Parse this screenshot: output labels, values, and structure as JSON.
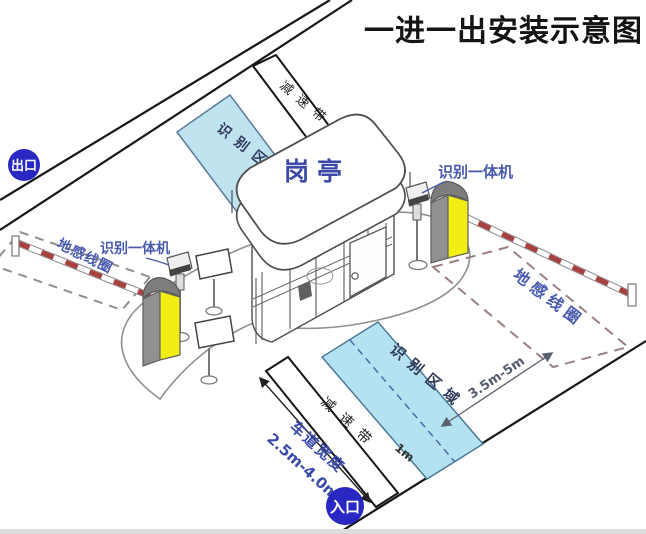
{
  "title": "一进一出安装示意图",
  "badges": {
    "exit": "出口",
    "entrance": "入口"
  },
  "booth": {
    "label": "岗亭"
  },
  "equipment": {
    "camera_left_label": "识别一体机",
    "camera_right_label": "识别一体机"
  },
  "ground": {
    "loop_left_label": "地感线圈",
    "loop_right_label": "地感线圈",
    "zone_top_label": "识别区域",
    "zone_bottom_label": "识别区域",
    "bump_top_label": "减速带",
    "bump_bottom_label": "减速带"
  },
  "dimensions": {
    "lane_width_label": "车道宽度",
    "lane_width_value": "2.5m-4.0m",
    "loop_to_zone": "3.5m-5m",
    "zone_half_width": "1m"
  },
  "colors": {
    "badge_blue": "#2a28c2",
    "label_blue": "#3b4aa8",
    "zone_fill": "#b5e2f0",
    "zone_border": "#4a7a9a",
    "machine_yellow": "#f2ee12",
    "arm_red": "#a84040",
    "line_black": "#161616"
  }
}
